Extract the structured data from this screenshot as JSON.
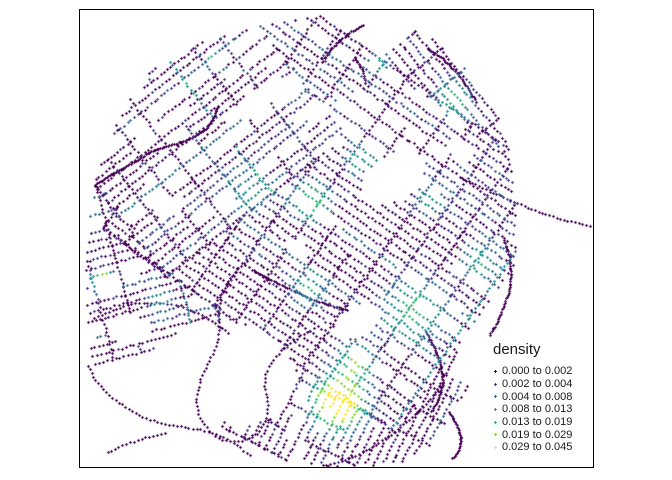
{
  "figure": {
    "background": "#ffffff",
    "panel": {
      "left": 79,
      "top": 9,
      "width": 515,
      "height": 459,
      "border_color": "#000000"
    }
  },
  "legend": {
    "title": "density",
    "entries": [
      {
        "label": "0.000 to 0.002",
        "color": "#440154"
      },
      {
        "label": "0.002 to 0.004",
        "color": "#443983"
      },
      {
        "label": "0.004 to 0.008",
        "color": "#31688e"
      },
      {
        "label": "0.008 to 0.013",
        "color": "#21918c"
      },
      {
        "label": "0.013 to 0.019",
        "color": "#35b779"
      },
      {
        "label": "0.019 to 0.029",
        "color": "#90d743"
      },
      {
        "label": "0.029 to 0.045",
        "color": "#fde725"
      }
    ]
  },
  "chart_data": {
    "type": "scatter",
    "subtype": "street-network density point map",
    "legend_title": "density",
    "bins": [
      "0.000 to 0.002",
      "0.002 to 0.004",
      "0.004 to 0.008",
      "0.008 to 0.013",
      "0.013 to 0.019",
      "0.019 to 0.029",
      "0.029 to 0.045"
    ],
    "bin_thresholds": [
      0,
      0.002,
      0.004,
      0.008,
      0.013,
      0.019,
      0.029,
      0.045
    ],
    "palette": [
      "#440154",
      "#443983",
      "#31688e",
      "#21918c",
      "#35b779",
      "#90d743",
      "#fde725"
    ],
    "marker": "cross",
    "grid": false,
    "axes_visible": false,
    "legend_position": "inside-bottom-right"
  },
  "map_model": {
    "seed": 20240613,
    "palette": [
      "#440154",
      "#443983",
      "#31688e",
      "#21918c",
      "#35b779",
      "#90d743",
      "#fde725"
    ],
    "thresholds": [
      0.002,
      0.004,
      0.008,
      0.013,
      0.019,
      0.029
    ],
    "clip": {
      "x0": 81,
      "y0": 11,
      "x1": 592,
      "y1": 466
    },
    "jitter": 1.4,
    "outline": [
      [
        148,
        72
      ],
      [
        185,
        48
      ],
      [
        225,
        34
      ],
      [
        268,
        24
      ],
      [
        310,
        16
      ],
      [
        352,
        14
      ],
      [
        395,
        22
      ],
      [
        430,
        36
      ],
      [
        455,
        55
      ],
      [
        472,
        75
      ],
      [
        488,
        95
      ],
      [
        500,
        118
      ],
      [
        508,
        145
      ],
      [
        512,
        175
      ],
      [
        515,
        210
      ],
      [
        516,
        245
      ],
      [
        512,
        278
      ],
      [
        504,
        310
      ],
      [
        494,
        340
      ],
      [
        478,
        372
      ],
      [
        458,
        402
      ],
      [
        440,
        430
      ],
      [
        425,
        452
      ],
      [
        405,
        462
      ],
      [
        378,
        465
      ],
      [
        350,
        468
      ],
      [
        322,
        468
      ],
      [
        298,
        458
      ],
      [
        272,
        464
      ],
      [
        248,
        462
      ],
      [
        222,
        452
      ],
      [
        196,
        440
      ],
      [
        168,
        432
      ],
      [
        140,
        422
      ],
      [
        114,
        405
      ],
      [
        99,
        382
      ],
      [
        90,
        352
      ],
      [
        86,
        318
      ],
      [
        85,
        280
      ],
      [
        86,
        242
      ],
      [
        90,
        205
      ],
      [
        97,
        172
      ],
      [
        108,
        140
      ],
      [
        125,
        105
      ]
    ],
    "holes": [
      [
        393,
        178,
        34,
        22,
        -35
      ],
      [
        357,
        320,
        24,
        14,
        -35
      ],
      [
        253,
        103,
        20,
        12,
        -38
      ],
      [
        318,
        112,
        14,
        9,
        -38
      ],
      [
        228,
        372,
        68,
        50,
        15
      ],
      [
        168,
        206,
        16,
        10,
        -15
      ],
      [
        298,
        248,
        13,
        8,
        35
      ],
      [
        460,
        150,
        16,
        9,
        40
      ],
      [
        130,
        330,
        22,
        14,
        0
      ]
    ],
    "hotspots": [
      [
        338,
        402,
        0.045,
        16
      ],
      [
        355,
        362,
        0.02,
        12
      ],
      [
        103,
        281,
        0.034,
        7
      ],
      [
        160,
        300,
        0.013,
        8
      ],
      [
        215,
        62,
        0.03,
        5
      ],
      [
        310,
        200,
        0.017,
        13
      ],
      [
        360,
        160,
        0.012,
        10
      ],
      [
        415,
        310,
        0.016,
        20
      ],
      [
        455,
        100,
        0.014,
        12
      ],
      [
        480,
        262,
        0.012,
        13
      ],
      [
        290,
        90,
        0.011,
        9
      ],
      [
        250,
        190,
        0.009,
        14
      ],
      [
        430,
        200,
        0.01,
        10
      ],
      [
        378,
        64,
        0.011,
        7
      ],
      [
        308,
        290,
        0.013,
        11
      ]
    ],
    "districts": [
      {
        "cx": 205,
        "cy": 140,
        "angle": -38,
        "len": 230,
        "wid": 175,
        "streetSpacing": 8.5,
        "crossSpacing": 27,
        "step": 4.3
      },
      {
        "cx": 335,
        "cy": 210,
        "angle": 35,
        "len": 360,
        "wid": 300,
        "streetSpacing": 8.5,
        "crossSpacing": 27,
        "step": 4.3
      },
      {
        "cx": 160,
        "cy": 255,
        "angle": -15,
        "len": 200,
        "wid": 180,
        "streetSpacing": 8.5,
        "crossSpacing": 28,
        "step": 4.3
      },
      {
        "cx": 345,
        "cy": 405,
        "angle": -63,
        "len": 150,
        "wid": 200,
        "streetSpacing": 8,
        "crossSpacing": 26,
        "step": 4.2
      },
      {
        "cx": 440,
        "cy": 108,
        "angle": 50,
        "len": 150,
        "wid": 130,
        "streetSpacing": 9,
        "crossSpacing": 30,
        "step": 4.3
      }
    ],
    "roads": [
      {
        "pts": [
          [
            95,
            185
          ],
          [
            112,
            174
          ],
          [
            132,
            163
          ],
          [
            150,
            152
          ],
          [
            163,
            147
          ],
          [
            178,
            143
          ],
          [
            194,
            137
          ],
          [
            207,
            128
          ],
          [
            214,
            117
          ],
          [
            218,
            106
          ]
        ],
        "step": 1.6
      },
      {
        "pts": [
          [
            462,
            178
          ],
          [
            476,
            185
          ],
          [
            492,
            192
          ],
          [
            508,
            199
          ],
          [
            526,
            207
          ],
          [
            544,
            214
          ],
          [
            562,
            219
          ],
          [
            578,
            223
          ],
          [
            590,
            226
          ]
        ],
        "step": 3.8
      },
      {
        "pts": [
          [
            428,
            48
          ],
          [
            444,
            60
          ],
          [
            458,
            74
          ],
          [
            468,
            88
          ],
          [
            476,
            102
          ]
        ],
        "step": 2.2
      },
      {
        "pts": [
          [
            456,
            352
          ],
          [
            447,
            370
          ],
          [
            437,
            390
          ],
          [
            424,
            406
          ],
          [
            408,
            420
          ],
          [
            392,
            434
          ],
          [
            374,
            446
          ],
          [
            355,
            456
          ],
          [
            336,
            463
          ],
          [
            318,
            467
          ]
        ],
        "step": 3.8
      },
      {
        "pts": [
          [
            449,
            412
          ],
          [
            456,
            424
          ],
          [
            461,
            437
          ],
          [
            459,
            450
          ],
          [
            452,
            459
          ]
        ],
        "step": 1.7
      },
      {
        "pts": [
          [
            504,
            240
          ],
          [
            509,
            256
          ],
          [
            511,
            273
          ],
          [
            509,
            290
          ],
          [
            504,
            306
          ],
          [
            497,
            322
          ],
          [
            489,
            336
          ]
        ],
        "step": 2.0
      },
      {
        "pts": [
          [
            427,
            334
          ],
          [
            435,
            350
          ],
          [
            441,
            366
          ],
          [
            443,
            382
          ],
          [
            439,
            398
          ],
          [
            431,
            412
          ]
        ],
        "step": 1.8
      },
      {
        "pts": [
          [
            250,
            258
          ],
          [
            238,
            268
          ],
          [
            228,
            280
          ],
          [
            221,
            294
          ],
          [
            218,
            310
          ],
          [
            220,
            328
          ],
          [
            216,
            346
          ],
          [
            208,
            362
          ],
          [
            200,
            380
          ],
          [
            196,
            398
          ],
          [
            199,
            416
          ],
          [
            208,
            430
          ],
          [
            222,
            440
          ],
          [
            240,
            442
          ],
          [
            256,
            434
          ],
          [
            266,
            420
          ],
          [
            268,
            404
          ],
          [
            264,
            388
          ],
          [
            266,
            372
          ],
          [
            274,
            358
          ],
          [
            286,
            346
          ],
          [
            300,
            336
          ],
          [
            314,
            328
          ]
        ],
        "step": 4.0
      },
      {
        "pts": [
          [
            88,
            366
          ],
          [
            97,
            382
          ],
          [
            110,
            396
          ],
          [
            126,
            408
          ],
          [
            144,
            418
          ],
          [
            164,
            424
          ],
          [
            184,
            427
          ],
          [
            204,
            430
          ],
          [
            222,
            436
          ],
          [
            238,
            446
          ],
          [
            250,
            456
          ]
        ],
        "step": 4.0
      },
      {
        "pts": [
          [
            108,
            452
          ],
          [
            126,
            444
          ],
          [
            146,
            437
          ],
          [
            166,
            433
          ]
        ],
        "step": 4.0
      },
      {
        "pts": [
          [
            94,
            318
          ],
          [
            112,
            310
          ],
          [
            132,
            304
          ],
          [
            154,
            302
          ],
          [
            176,
            305
          ],
          [
            196,
            312
          ],
          [
            214,
            322
          ],
          [
            230,
            334
          ]
        ],
        "step": 4.0
      },
      {
        "pts": [
          [
            252,
            270
          ],
          [
            272,
            280
          ],
          [
            292,
            290
          ],
          [
            312,
            299
          ],
          [
            332,
            306
          ],
          [
            348,
            310
          ]
        ],
        "step": 2.2
      },
      {
        "pts": [
          [
            322,
            62
          ],
          [
            330,
            50
          ],
          [
            340,
            40
          ],
          [
            352,
            31
          ],
          [
            364,
            25
          ]
        ],
        "step": 2.0
      },
      {
        "pts": [
          [
            355,
            58
          ],
          [
            362,
            70
          ],
          [
            366,
            84
          ]
        ],
        "step": 1.8
      },
      {
        "pts": [
          [
            118,
            238
          ],
          [
            132,
            250
          ],
          [
            148,
            262
          ],
          [
            166,
            272
          ]
        ],
        "step": 3.5
      }
    ]
  }
}
